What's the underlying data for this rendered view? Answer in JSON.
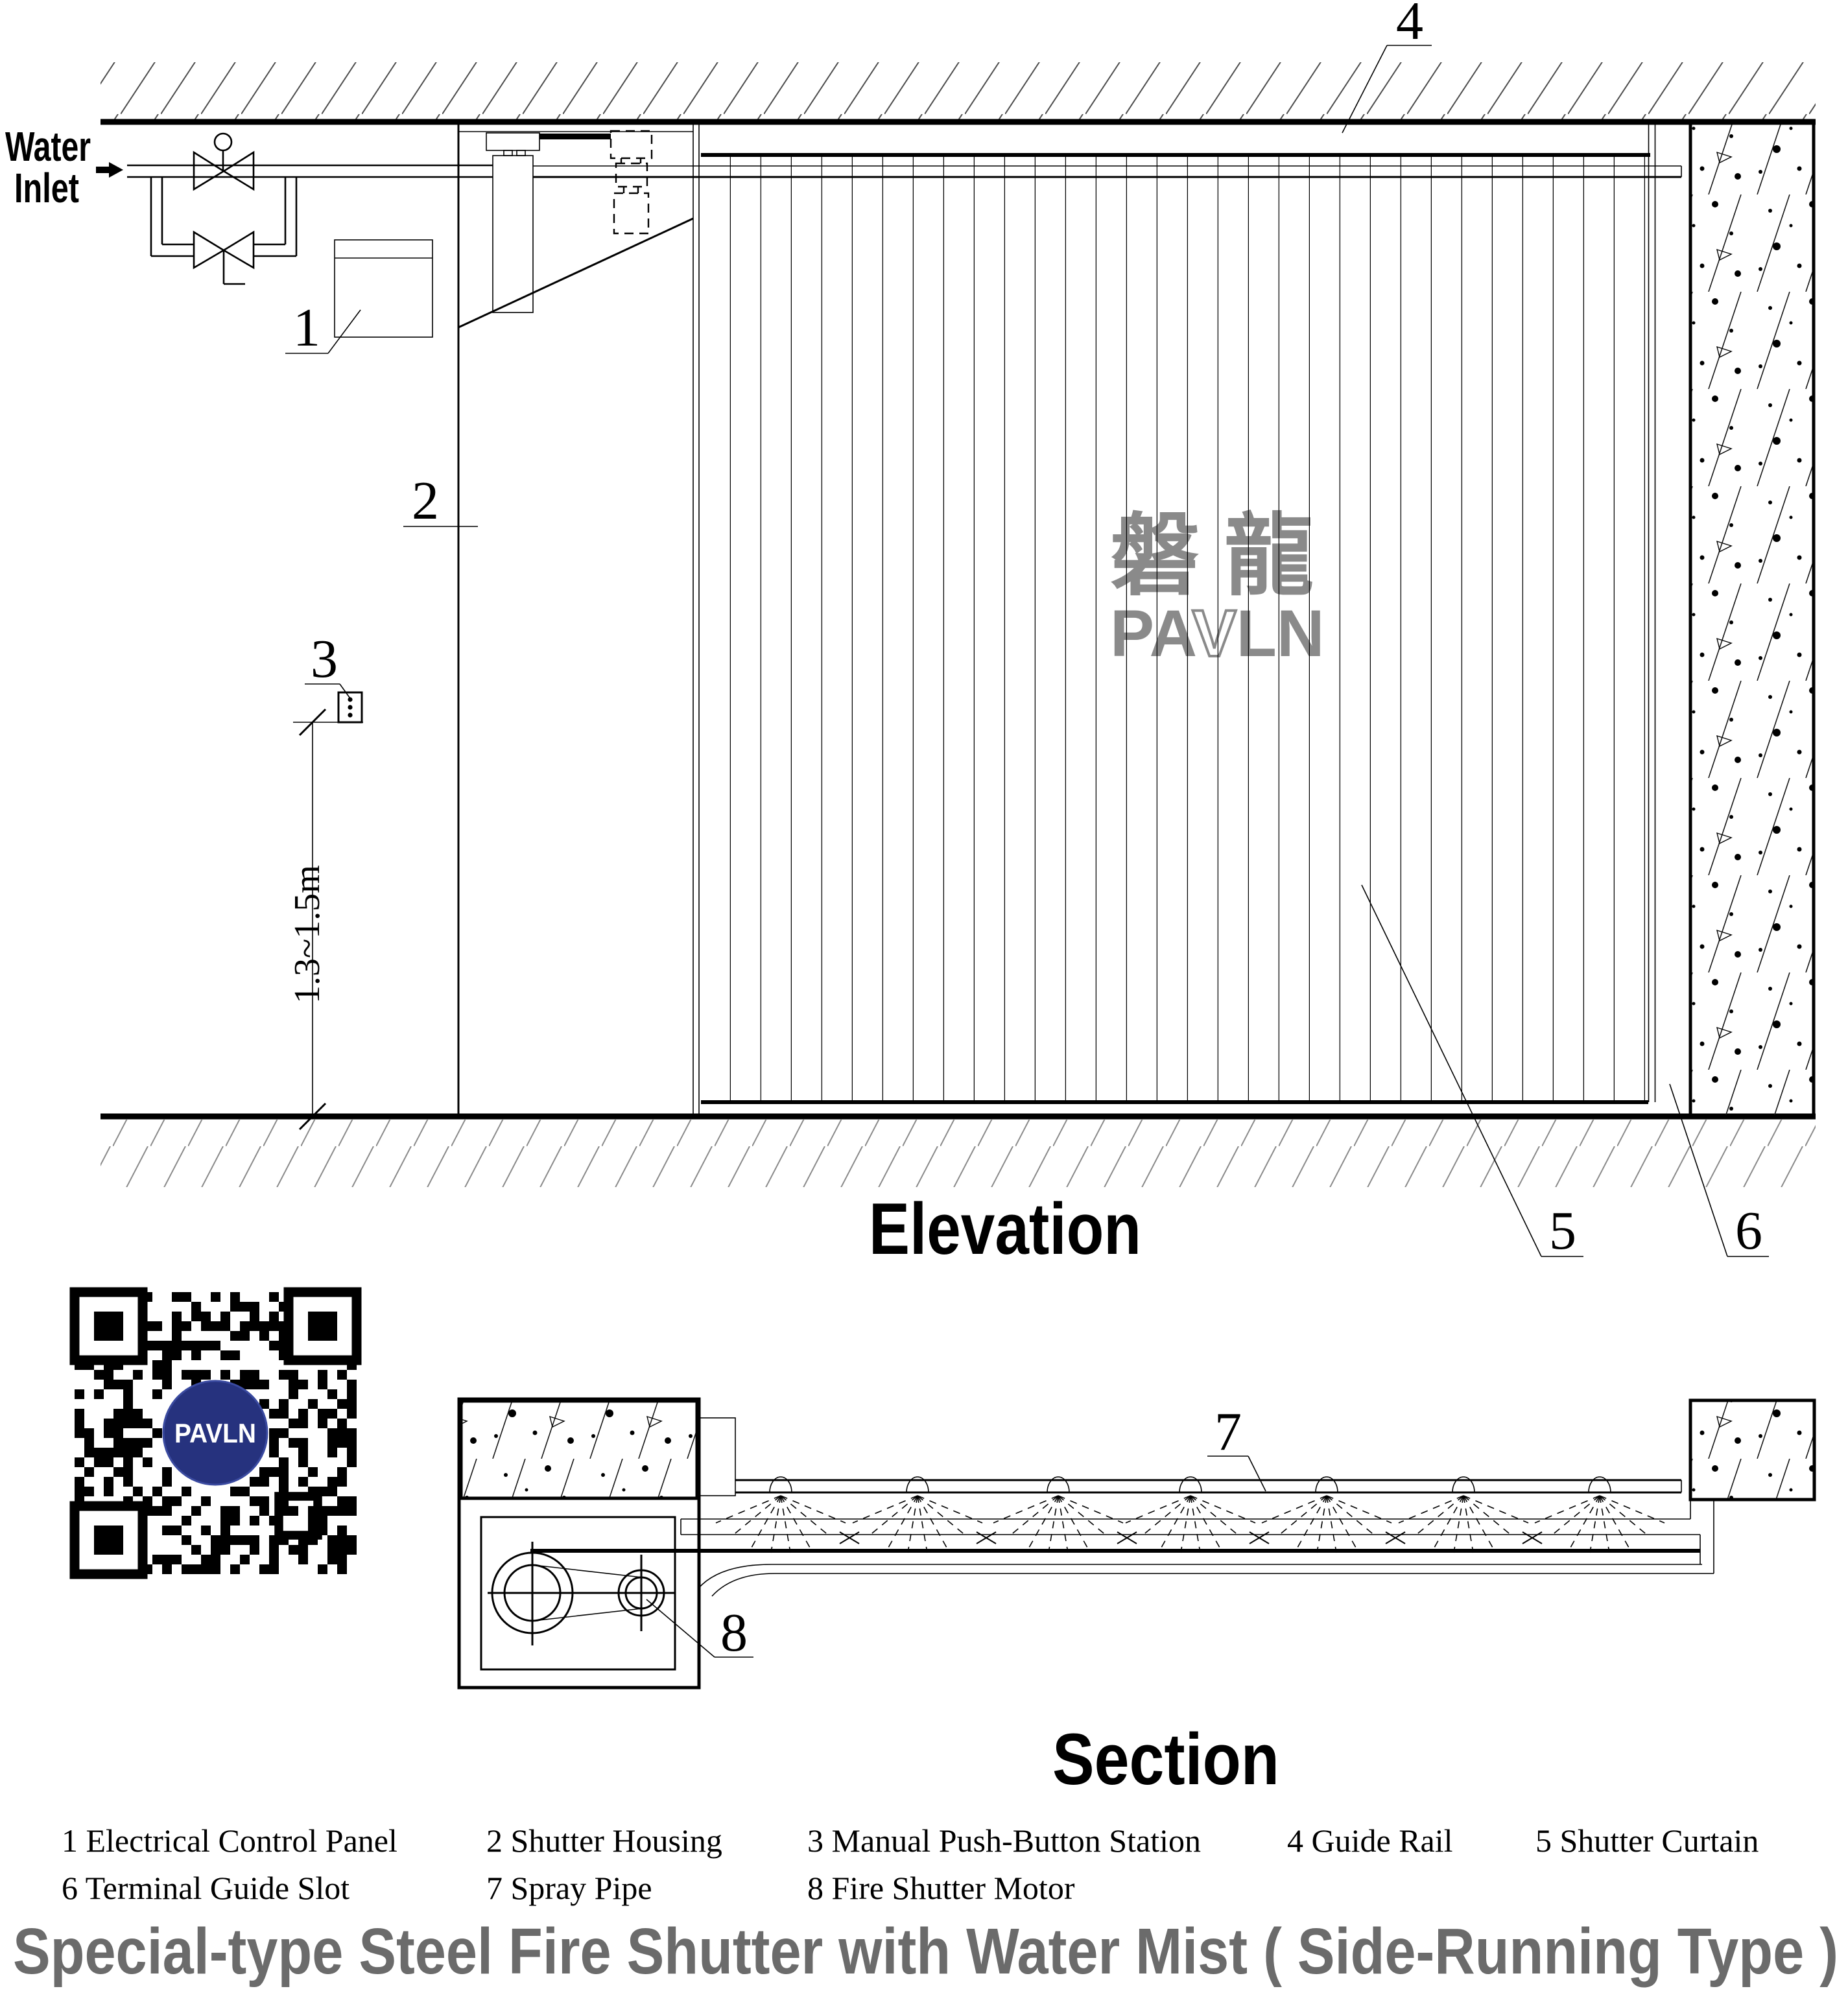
{
  "drawing": {
    "water_inlet": {
      "line1": "Water",
      "line2": "Inlet"
    },
    "dimension_label": "1.3~1.5m",
    "callouts": {
      "c1": "1",
      "c2": "2",
      "c3": "3",
      "c4": "4",
      "c5": "5",
      "c6": "6",
      "c7": "7",
      "c8": "8"
    },
    "views": {
      "elevation": "Elevation",
      "section": "Section"
    },
    "watermark": {
      "cjk": "磐龍",
      "latin_pa": "PA",
      "latin_v": "V",
      "latin_ln": "LN"
    },
    "qr_badge": "PAVLN",
    "legend": {
      "row1": [
        "1 Electrical Control Panel",
        "2 Shutter Housing",
        "3 Manual Push-Button Station",
        "4 Guide Rail",
        "5 Shutter Curtain"
      ],
      "row2": [
        "6 Terminal Guide Slot",
        "7 Spray Pipe",
        "8 Fire Shutter Motor"
      ]
    },
    "title": "Special-type Steel Fire Shutter with Water Mist ( Side-Running Type )",
    "colors": {
      "line": "#000000",
      "watermark_gray": "#8a8a8a",
      "title_gray": "#6b6b6b",
      "qr_navy": "#26327e",
      "hatch_gray": "#4d4d4d"
    }
  }
}
